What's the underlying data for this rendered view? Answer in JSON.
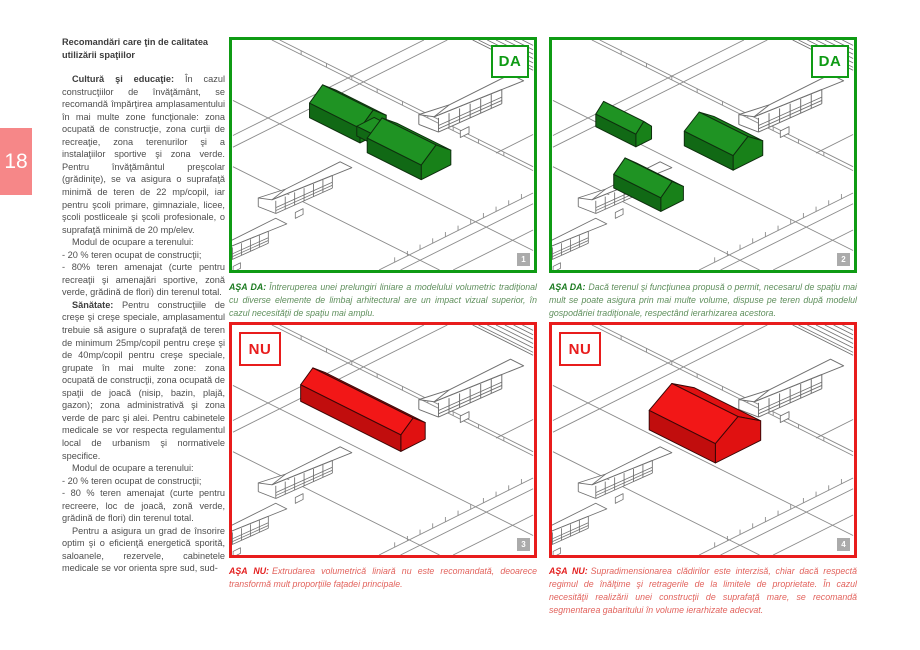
{
  "page": {
    "number": "18"
  },
  "colors": {
    "panel_green": "#0f9b14",
    "panel_red": "#e81c1c",
    "volume_green": "#1f9323",
    "volume_red": "#f21717",
    "caption_green_lead": "#1b7a1f",
    "caption_green_text": "#5f8f5c",
    "caption_red_lead": "#e31e1e",
    "caption_red_text": "#e2635d",
    "page_badge_pink": "#f68788"
  },
  "left_column": {
    "heading": "Recomandări care ţin de calitatea utilizării spaţiilor",
    "paragraphs": [
      {
        "lead": "Cultură şi educaţie:",
        "text": "În cazul construcţiilor de învăţământ, se recomandă împărţirea amplasamentului în mai multe zone funcţionale: zona ocupată de construcţie, zona curţii de recreaţie, zona terenurilor şi a instalaţiilor sportive şi zona verde. Pentru învăţământul preşcolar (grădiniţe), se va asigura o suprafaţă minimă de teren de 22 mp/copil, iar pentru şcoli primare, gimnaziale, licee, şcoli postliceale şi şcoli profesionale, o suprafaţă minimă de 20 mp/elev."
      },
      {
        "lead": "",
        "text": "Modul de ocupare a terenului:"
      },
      {
        "lead": "",
        "text": "- 20 % teren ocupat de construcţii;"
      },
      {
        "lead": "",
        "text": "- 80% teren amenajat (curte pentru recreaţii şi amenajări sportive, zonă verde, grădină de flori) din terenul total."
      },
      {
        "lead": "Sănătate:",
        "text": "Pentru construcţiile de creşe şi creşe speciale, amplasamentul trebuie să asigure o suprafaţă de teren de minimum 25mp/copil pentru creşe şi de 40mp/copil pentru creşe speciale, grupate în mai multe zone: zona ocupată de construcţii, zona ocupată de spaţii de joacă (nisip, bazin, plajă, gazon); zona administrativă şi zona verde de parc şi alei. Pentru cabinetele medicale se vor respecta regulamentul local de urbanism şi normativele specifice."
      },
      {
        "lead": "",
        "text": "Modul de ocupare a terenului:"
      },
      {
        "lead": "",
        "text": "- 20 % teren ocupat de construcţii;"
      },
      {
        "lead": "",
        "text": "- 80 % teren amenajat (curte pentru recreere, loc de joacă, zonă verde, grădină de flori) din terenul total."
      },
      {
        "lead": "",
        "text": "Pentru a asigura un grad de însorire optim şi o eficienţă energetică sporită, saloanele, rezervele, cabinetele medicale se vor orienta spre sud, sud-"
      }
    ]
  },
  "panels": [
    {
      "verdict": "DA",
      "number": "1",
      "caption_lead": "AŞA DA:",
      "caption_text": "Întreruperea unei prelungiri liniare a modelului volumetric tradiţional cu diverse elemente de limbaj arhitectural are un impact vizual superior, în cazul necesităţii de spaţiu mai amplu."
    },
    {
      "verdict": "DA",
      "number": "2",
      "caption_lead": "AŞA DA:",
      "caption_text": "Dacă terenul şi funcţiunea propusă o permit, necesarul de spaţiu mai mult se poate asigura prin mai multe volume, dispuse pe teren după modelul gospodăriei tradiţionale, respectând ierarhizarea acestora."
    },
    {
      "verdict": "NU",
      "number": "3",
      "caption_lead": "AŞA NU:",
      "caption_text": "Extrudarea volumetrică liniară nu este recomandată, deoarece transformă mult proporţiile faţadei principale."
    },
    {
      "verdict": "NU",
      "number": "4",
      "caption_lead": "AŞA NU:",
      "caption_text": "Supradimensionarea clădirilor este interzisă, chiar dacă respectă regimul de înălţime şi retragerile de la limitele de proprietate. În cazul necesităţii realizării unei construcţii de suprafaţă mare, se recomandă segmentarea gabaritului în volume ierarhizate adecvat."
    }
  ]
}
